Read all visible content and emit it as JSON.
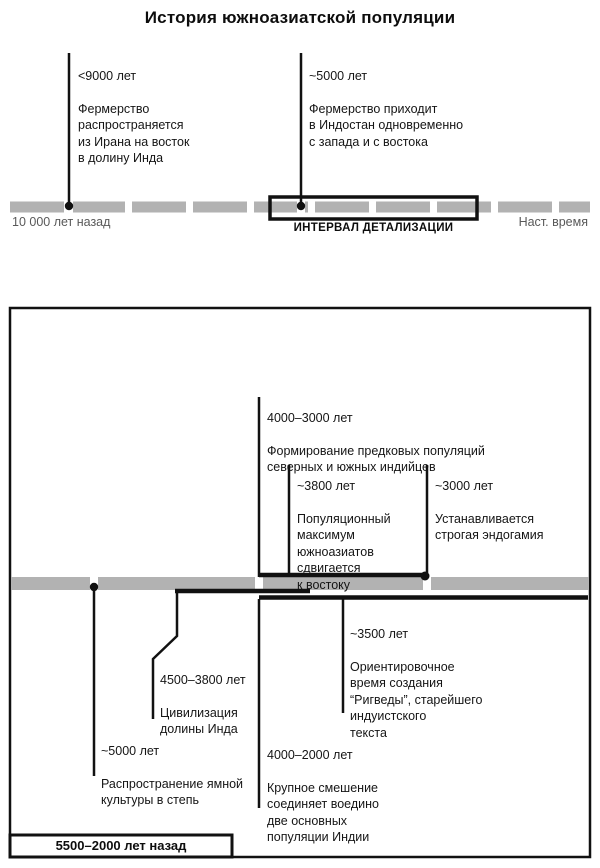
{
  "title": "История южноазиатской популяции",
  "overview_timeline": {
    "events": [
      {
        "years": "<9000 лет",
        "text": "Фермерство\nраспространяется\nиз Ирана на восток\nв долину Инда"
      },
      {
        "years": "~5000 лет",
        "text": "Фермерство приходит\nв Индостан одновременно\nс запада и с востока"
      }
    ],
    "axis_start_label": "10 000 лет назад",
    "axis_end_label": "Наст. время",
    "detail_interval_label": "ИНТЕРВАЛ ДЕТАЛИЗАЦИИ"
  },
  "detail_timeline": {
    "events_above": [
      {
        "years": "4000–3000 лет",
        "text": "Формирование предковых популяций\nсеверных и южных индийцев"
      },
      {
        "years": "~3800 лет",
        "text": "Популяционный\nмаксимум\nюжноазиатов\nсдвигается\nк востоку"
      },
      {
        "years": "~3000 лет",
        "text": "Устанавливается\nстрогая эндогамия"
      }
    ],
    "events_below": [
      {
        "years": "~3500 лет",
        "text": "Ориентировочное\nвремя создания\n“Ригведы”, старейшего\nиндуистского\nтекста"
      },
      {
        "years": "4500–3800 лет",
        "text": "Цивилизация\nдолины Инда"
      },
      {
        "years": "~5000 лет",
        "text": "Распространение ямной\nкультуры в степь"
      },
      {
        "years": "4000–2000 лет",
        "text": "Крупное смешение\nсоединяет воедино\nдве основных\nпопуляции Индии"
      }
    ],
    "range_label": "5500–2000 лет назад"
  },
  "colors": {
    "timeline_gray": "#b2b2b2",
    "ink": "#111111",
    "muted_label": "#595959"
  }
}
